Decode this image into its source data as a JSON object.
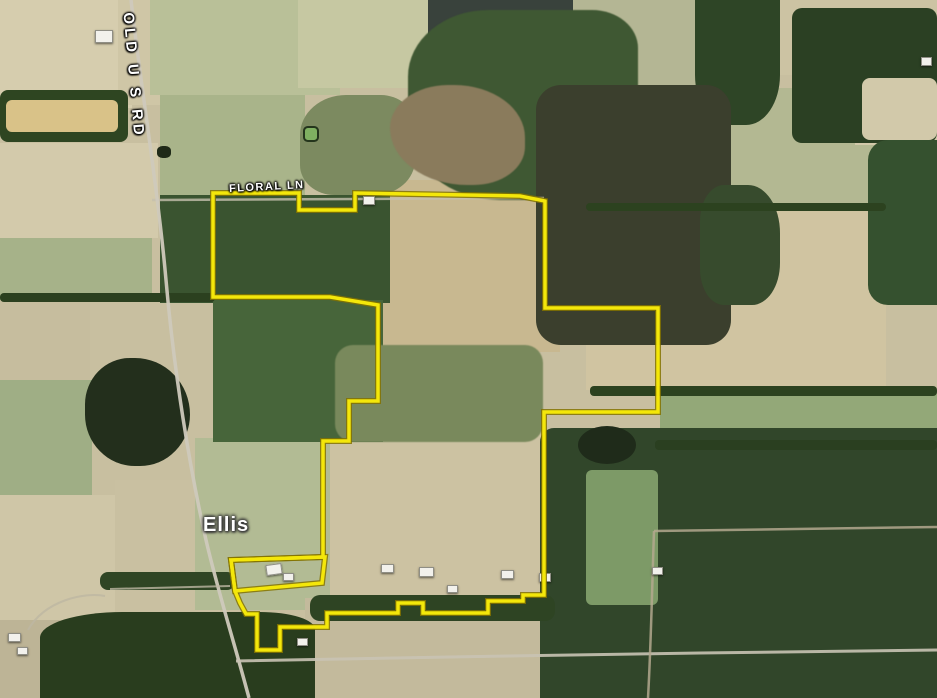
{
  "title": "Satellite parcel map",
  "labels": {
    "road_vertical": "OLD U S RD",
    "road_horizontal": "FLORAL LN",
    "place": "Ellis"
  },
  "boundary": {
    "color": "#f4e70a",
    "edge_color": "#847300",
    "main_points": "213,193 299,193 299,210 355,210 355,193 520,196 545,201 545,308 658,308 658,412 544,412 544,595 523,595 523,601 488,601 488,613 423,613 423,603 398,603 398,613 327,613 327,627 280,627 280,650 257,650 257,614 246,614 240,603 235,591 231,560 323,557 323,441 349,441 349,401 378,401 378,305 330,297 213,297",
    "homestead_lot_points": "231,560 325,557 322,583 235,591"
  },
  "roads": {
    "old_us_rd": "M131,0 C140,80 158,190 166,280 C174,372 190,470 206,540 C218,592 235,645 249,698",
    "floral_ln": "M152,200 L544,198",
    "bottom_road": "M236,661 C380,658 560,655 700,653 C800,652 880,651 937,650",
    "farm_lane": "M110,589 L230,586",
    "driveway": "M28,630 C45,600 85,592 105,596",
    "dirt_road_east": "M654,531 L937,527",
    "dirt_road_south": "M654,531 C652,590 651,645 648,698"
  },
  "palette": {
    "field_tan": "#d0c6a7",
    "field_green": "#a9b48a",
    "forest_dark": "#2e4423",
    "forest_olive": "#3b3f2d",
    "road_gray": "#cfc9bc"
  }
}
